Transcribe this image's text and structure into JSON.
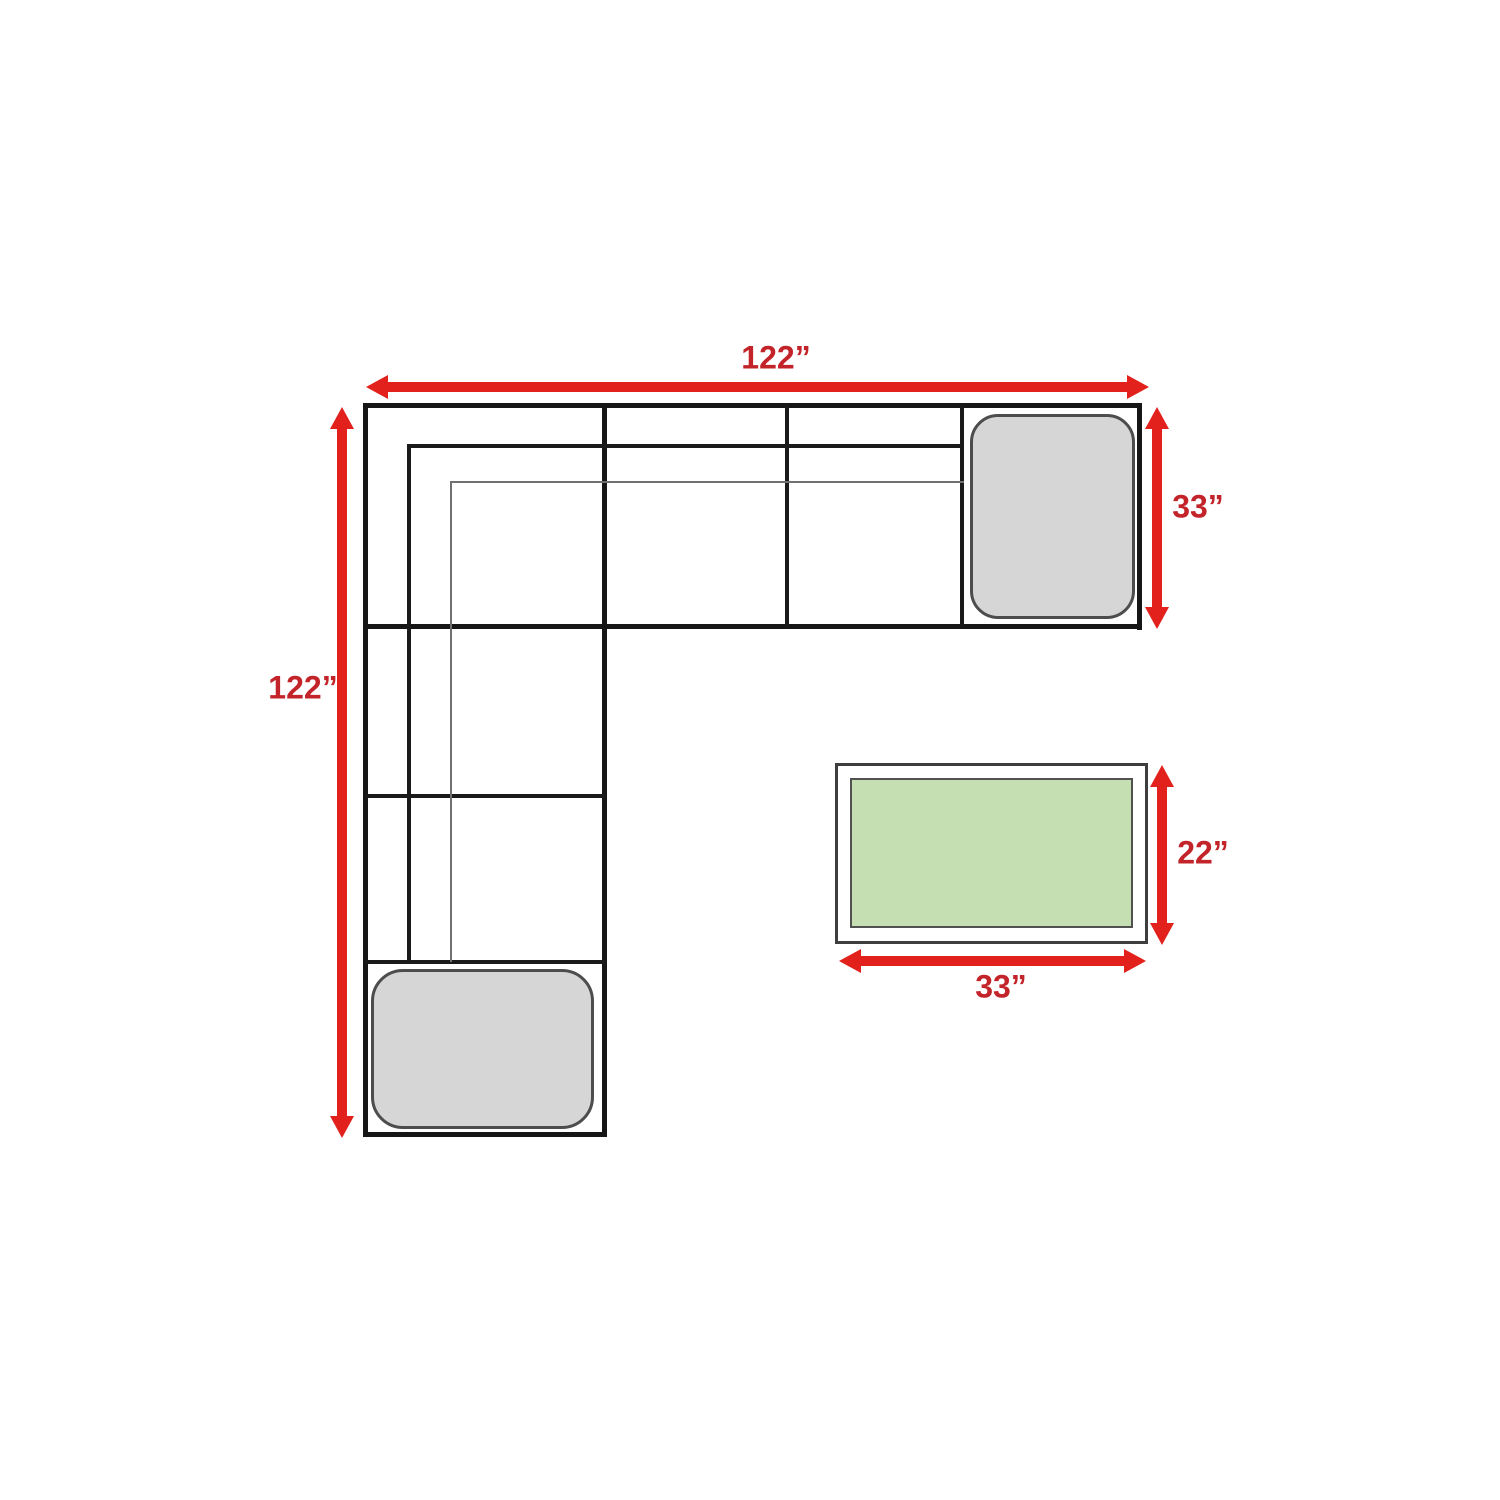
{
  "labels": {
    "sofa_width": "122”",
    "sofa_depth": "122”",
    "sofa_side_depth": "33”",
    "table_depth": "22”",
    "table_width": "33”"
  },
  "colors": {
    "arrow_red": "#E2211C",
    "label_red": "#C3242A",
    "cushion_gray": "#D6D6D6",
    "table_green": "#C5DFB3",
    "outline_black": "#161616"
  }
}
